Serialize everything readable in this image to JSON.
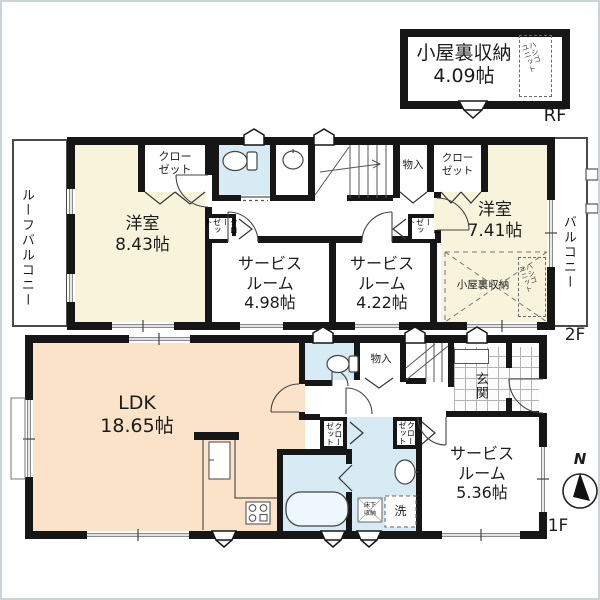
{
  "colors": {
    "wall": "#161616",
    "western_room_fill": "#f8f4dc",
    "ldk_fill": "#fae3c8",
    "wet_area_fill": "#d6ebf4",
    "frame_border": "#c9d4d8"
  },
  "rf": {
    "room_name": "小屋裏収納",
    "room_size": "4.09帖",
    "ladder_line1": "ハシゴ",
    "ladder_line2": "ユニット",
    "floor_label": "RF"
  },
  "f2": {
    "floor_label": "2F",
    "roof_balcony": "ルーフバルコニー",
    "balcony": "バルコニー",
    "western1_name": "洋室",
    "western1_size": "8.43帖",
    "western2_name": "洋室",
    "western2_size": "7.41帖",
    "service1_line1": "サービス",
    "service1_line2": "ルーム",
    "service1_size": "4.98帖",
    "service2_line1": "サービス",
    "service2_line2": "ルーム",
    "service2_size": "4.22帖",
    "closet_tl_line1": "クロー",
    "closet_tl_line2": "ゼット",
    "closet_tr_line1": "クロー",
    "closet_tr_line2": "ゼット",
    "closet_a_line1": "クロー",
    "closet_a_line2": "ゼット",
    "closet_b_line1": "クロー",
    "closet_b_line2": "ゼット",
    "storage": "物入",
    "attic": "小屋裏収納",
    "ladder_line1": "ハシゴ",
    "ladder_line2": "ユニット"
  },
  "f1": {
    "floor_label": "1F",
    "ldk_name": "LDK",
    "ldk_size": "18.65帖",
    "storage": "物入",
    "entrance": "玄関",
    "service_line1": "サービス",
    "service_line2": "ルーム",
    "service_size": "5.36帖",
    "closet_1_line1": "クロー",
    "closet_1_line2": "ゼット",
    "closet_2_line1": "クロー",
    "closet_2_line2": "ゼット",
    "underfloor_line1": "床下",
    "underfloor_line2": "収納",
    "washer": "洗"
  },
  "compass": {
    "north": "N"
  }
}
